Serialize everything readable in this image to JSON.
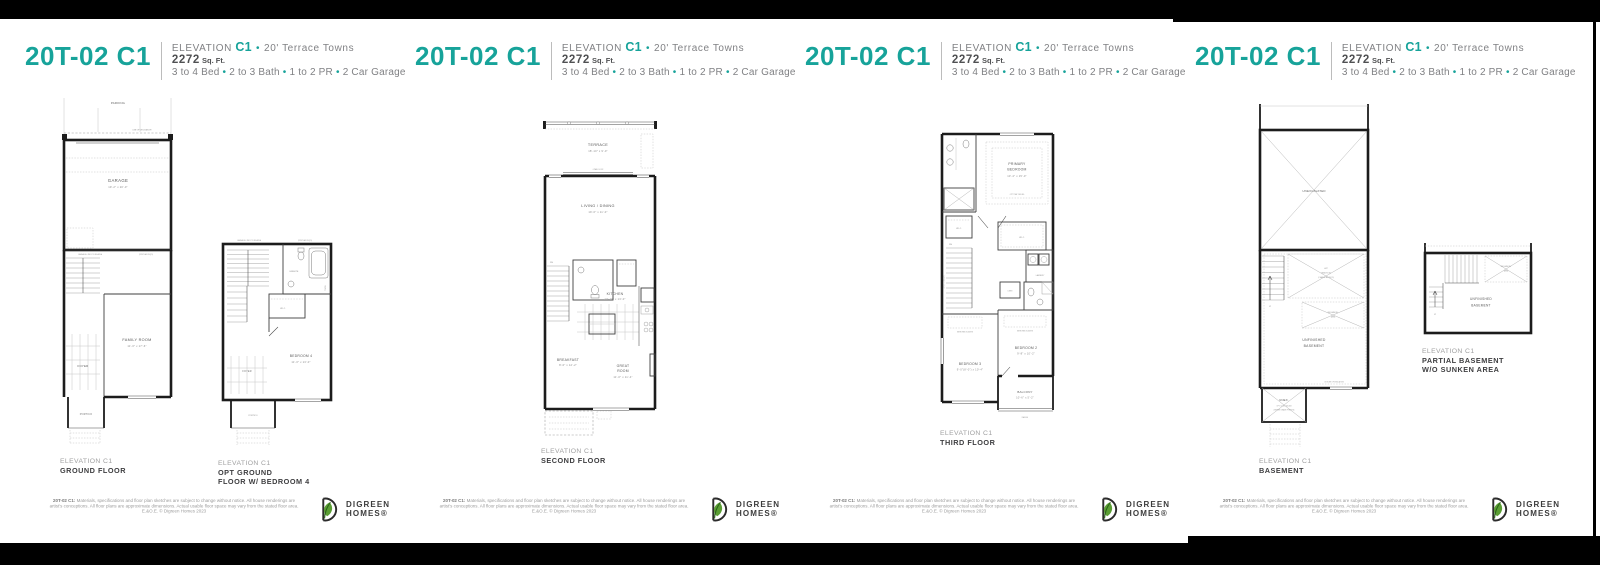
{
  "page": {
    "accent_teal": "#17a39a",
    "logo_green": "#5a9e33",
    "line_black": "#1c1c1c"
  },
  "header": {
    "title": "20T-02 C1",
    "elevation_label": "ELEVATION",
    "elevation_code": "C1",
    "bullet": "•",
    "series": "20' Terrace Towns",
    "sqft_value": "2272",
    "sqft_unit": "Sq. Ft.",
    "specs": [
      "3 to 4 Bed",
      "2 to 3 Bath",
      "1 to 2 PR",
      "2 Car Garage"
    ]
  },
  "footer": {
    "lead": "20T-02 C1:",
    "disclaimer": "Materials, specifications and floor plan sketches are subject to change without notice. All house renderings are artist's conceptions. All floor plans are approximate dimensions. Actual usable floor space may vary from the stated floor area. E.&O.E. © Digreen Homes 2023",
    "logo_line1": "DIGREEN",
    "logo_line2": "HOMES®"
  },
  "plans": {
    "ground": {
      "caption_elevation": "ELEVATION C1",
      "caption_floor": "GROUND FLOOR",
      "parking": "PARKING",
      "deck_note": "LINE OF DECK ABOVE",
      "garage": "GARAGE",
      "garage_dims": "19'-2\" x 20'-0\"",
      "garbage_note": "GARBAGE & RECYCLING AREA",
      "steps_note": "(STEPS AS REQ'D)",
      "family_room": "FAMILY ROOM",
      "family_room_dims": "11'-0\" x 17'-6\"",
      "foyer": "FOYER",
      "portico": "PORTICO"
    },
    "opt_ground": {
      "caption_elevation": "ELEVATION C1",
      "caption_floor1": "OPT GROUND",
      "caption_floor2": "FLOOR W/ BEDROOM 4",
      "garbage_note": "GARBAGE & RECYCLING AREA",
      "steps_note": "(STEPS AS REQ'D)",
      "ensuite": "ENSUITE",
      "wic": "W.I.C.",
      "towel": "TOWEL",
      "bedroom4": "BEDROOM 4",
      "bedroom4_dims": "11'-0\" x 13'-0\"",
      "foyer": "FOYER",
      "portico": "PORTICO"
    },
    "second": {
      "caption_elevation": "ELEVATION C1",
      "caption_floor": "SECOND FLOOR",
      "terrace": "TERRACE",
      "terrace_dims": "18'-10\" x 9'-0\"",
      "door_note": "6 PANL DOOR",
      "living": "LIVING / DINING",
      "living_dims": "19'-0\" x 11'-0\"",
      "dn": "DN",
      "kitchen": "KITCHEN",
      "kitchen_dims": "13'-10\" x 13'-0\"",
      "breakfast": "BREAKFAST",
      "breakfast_dims": "8'-0\" x 12'-2\"",
      "great1": "GREAT",
      "great2": "ROOM",
      "great_dims": "11'-0\" x 11'-4\""
    },
    "third": {
      "caption_elevation": "ELEVATION C1",
      "caption_floor": "THIRD FLOOR",
      "primary1": "PRIMARY",
      "primary2": "BEDROOM",
      "primary_dims": "13'-4\" x 15'-0\"",
      "tray_note": "OPT TRAY CEILING",
      "wic": "W.I.C.",
      "wic2": "W.I.C.",
      "dn": "DN",
      "open_below": "OPEN TO BELOW",
      "laundry": "LAUNDRY",
      "linen": "LINEN",
      "sliders_note": "MIRRORED SLIDERS",
      "bedroom3": "BEDROOM 3",
      "bedroom3_dims": "9'-0\"(8'-0\") x 10'-4\"",
      "bedroom2": "BEDROOM 2",
      "bedroom2_dims": "9'-8\" x 10'-2\"",
      "balcony": "BALCONY",
      "balcony_dims": "10'-6\" x 5'-2\"",
      "railing": "RAILING"
    },
    "basement": {
      "caption_elevation": "ELEVATION C1",
      "caption_floor": "BASEMENT",
      "unexcavated": "UNEXCAVATED",
      "up": "UP",
      "hwt1": "HWT",
      "hwt2": "HEADROOM",
      "hwt3": "(CHANGE AS REQ'D)",
      "mech1": "MECHANICAL",
      "mech2": "AREA",
      "unfinished1": "UNFINISHED",
      "unfinished2": "BASEMENT",
      "insulation_note": "OUTLINE OF INSULATION",
      "unex": "UNEX.",
      "cold1": "OPT. COLD CELLAR",
      "cold2": "(WHERE GRADE PERMITS)"
    },
    "partial_basement": {
      "caption_elevation": "ELEVATION C1",
      "caption_floor1": "PARTIAL BASEMENT",
      "caption_floor2": "W/O SUNKEN AREA",
      "up": "UP",
      "mech1": "MECHANICAL",
      "mech2": "AREA",
      "unfinished1": "UNFINISHED",
      "unfinished2": "BASEMENT"
    }
  }
}
